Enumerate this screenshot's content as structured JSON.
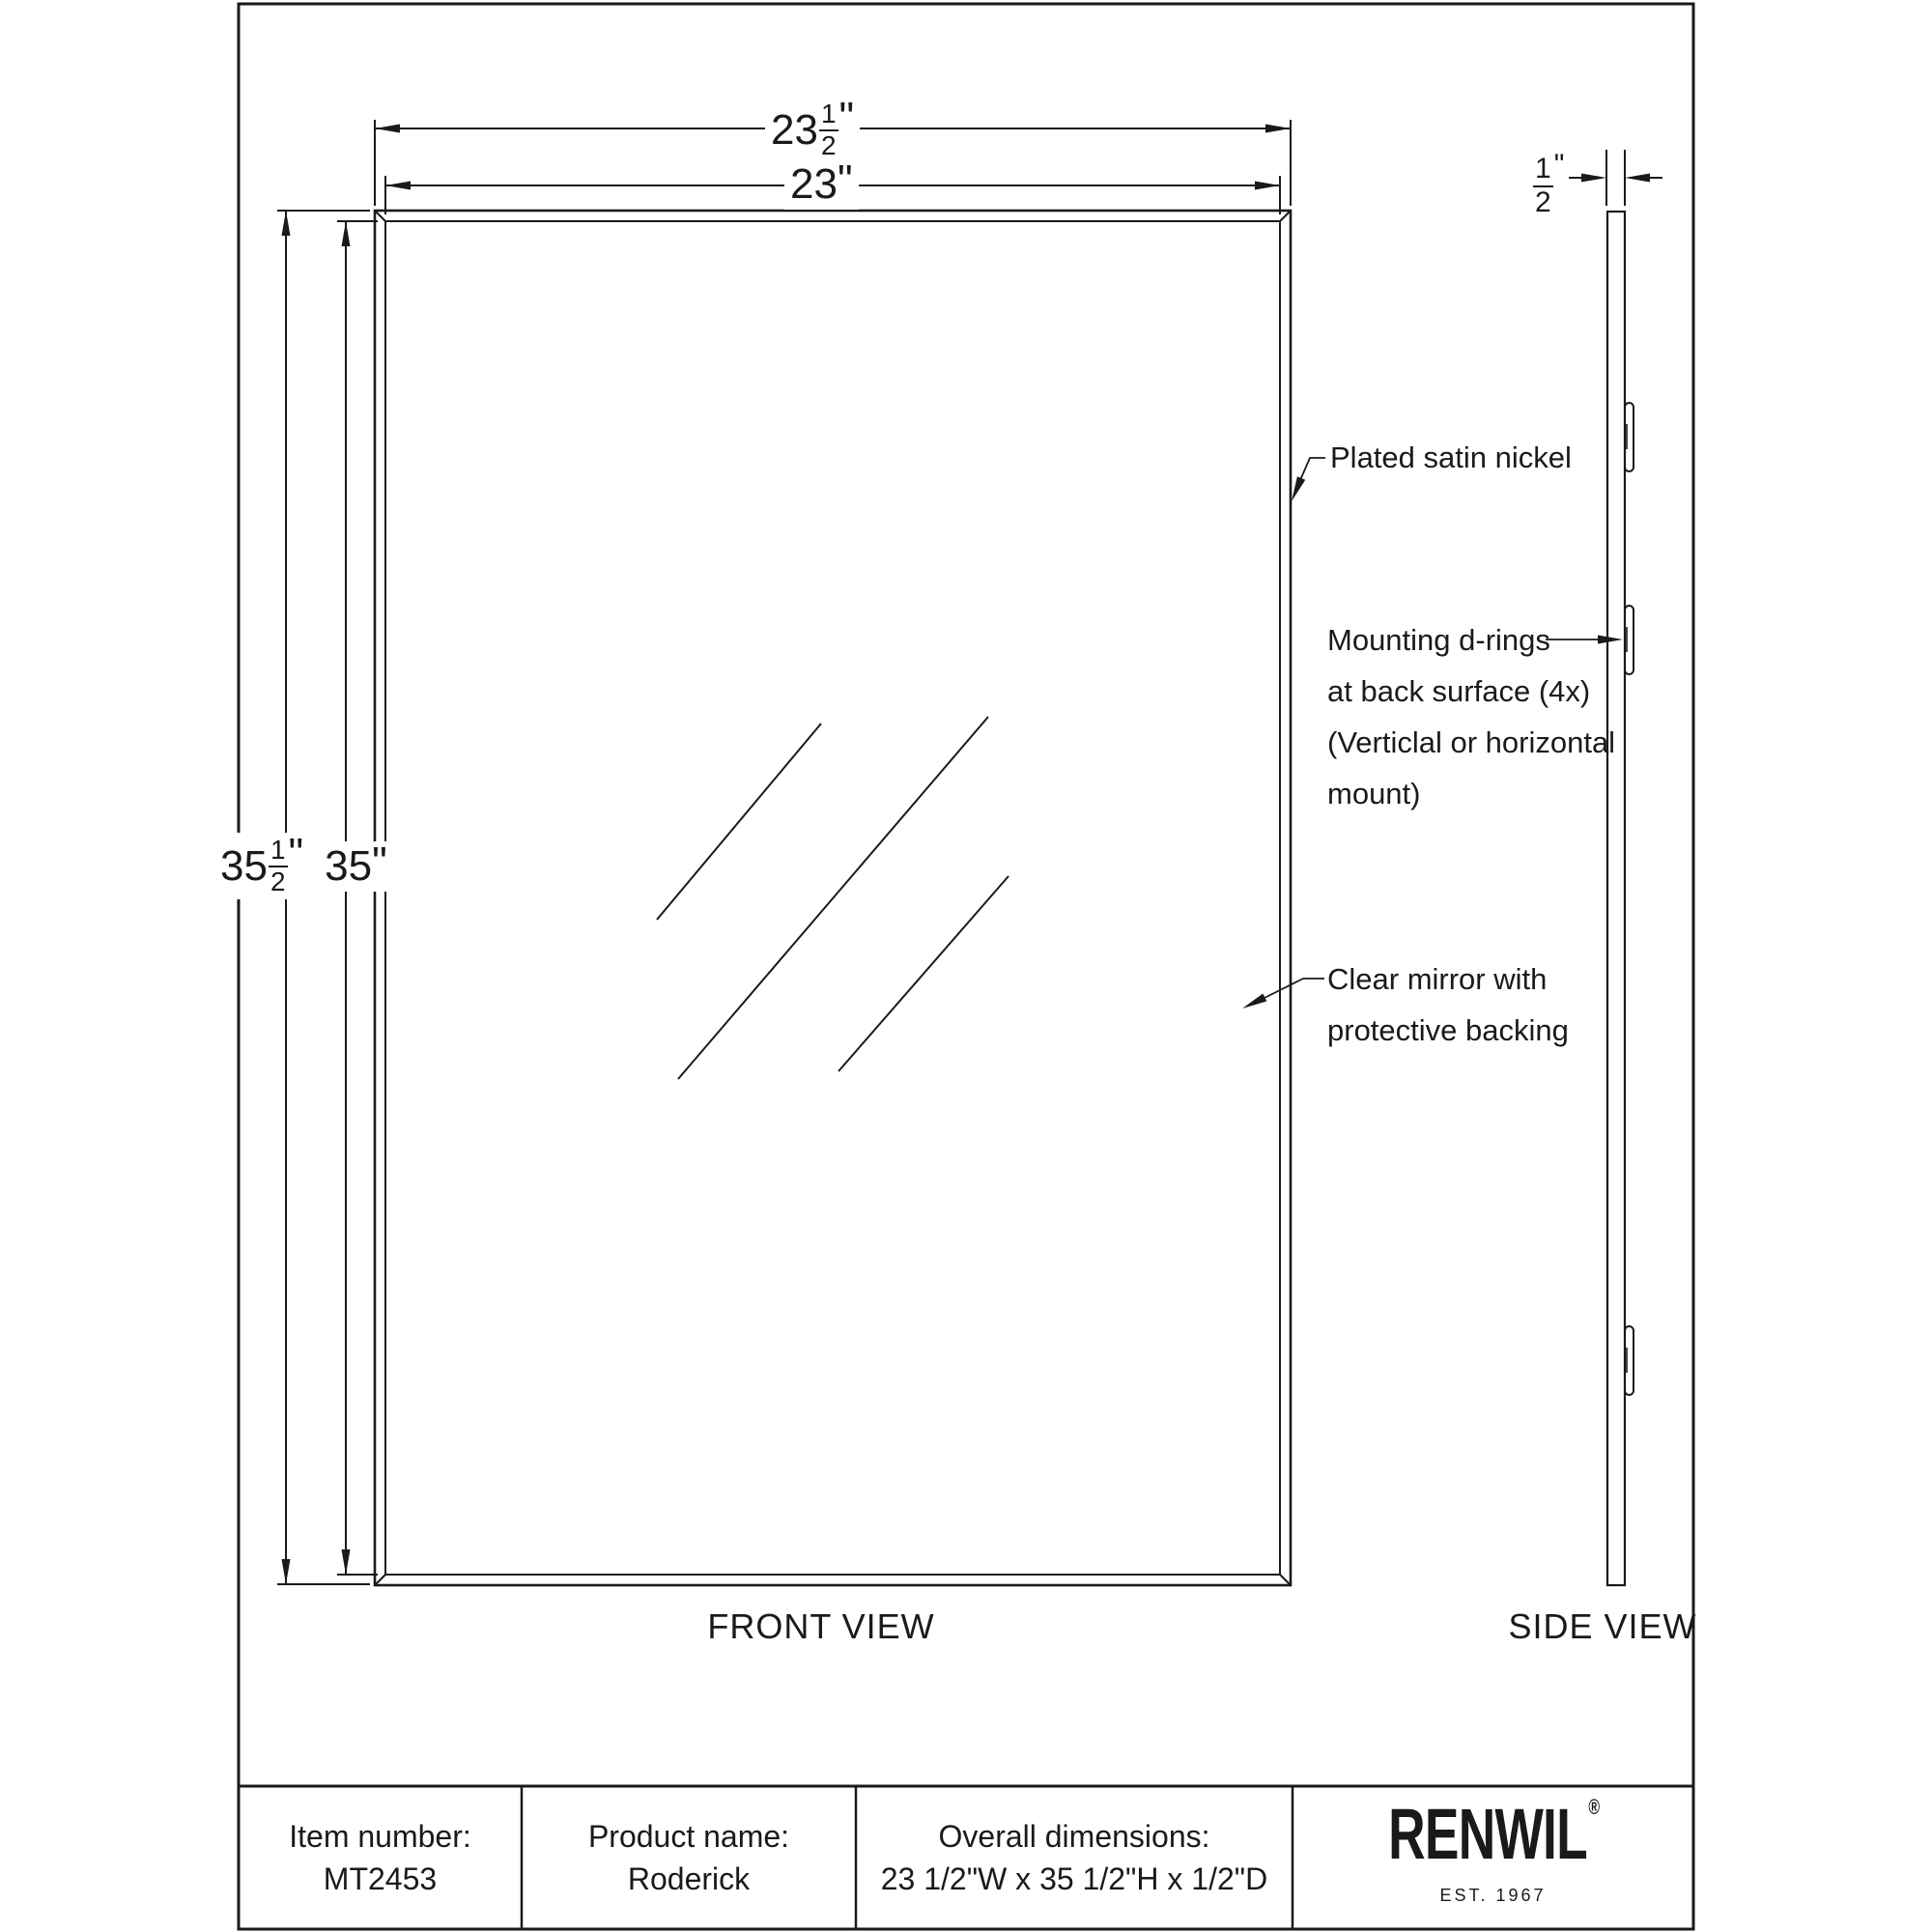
{
  "ink": "#1a1a1a",
  "views": {
    "front_label": "FRONT VIEW",
    "side_label": "SIDE VIEW"
  },
  "dimensions": {
    "width_overall": {
      "whole": "23",
      "num": "1",
      "den": "2",
      "unit": "\""
    },
    "width_mirror": {
      "value": "23",
      "unit": "\""
    },
    "height_overall": {
      "whole": "35",
      "num": "1",
      "den": "2",
      "unit": "\""
    },
    "height_mirror": {
      "value": "35",
      "unit": "\""
    },
    "depth": {
      "num": "1",
      "den": "2",
      "unit": "\""
    }
  },
  "annotations": {
    "frame_finish": "Plated satin nickel",
    "drings_line1": "Mounting d-rings",
    "drings_line2": "at back surface (4x)",
    "drings_line3": "(Verticlal or horizontal",
    "drings_line4": "mount)",
    "mirror_line1": "Clear mirror with",
    "mirror_line2": "protective backing"
  },
  "title_block": {
    "item_number_label": "Item number:",
    "item_number": "MT2453",
    "product_name_label": "Product name:",
    "product_name": "Roderick",
    "overall_label": "Overall dimensions:",
    "overall_value": "23 1/2\"W x 35 1/2\"H x 1/2\"D",
    "brand": "RENWIL",
    "brand_reg": "®",
    "brand_est": "EST. 1967"
  }
}
